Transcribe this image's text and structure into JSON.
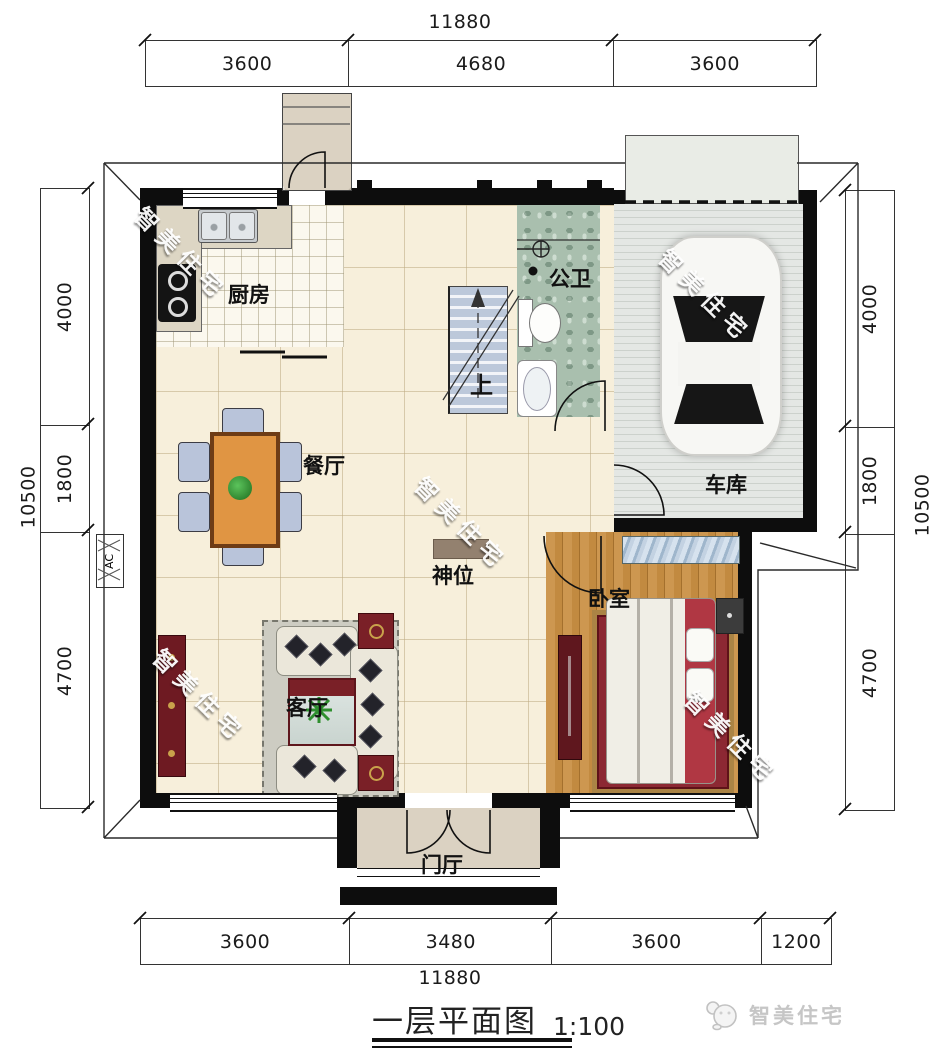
{
  "plan": {
    "title": "一层平面图",
    "scale": "1:100",
    "brand": "智美住宅",
    "watermark": "智美住宅"
  },
  "dims": {
    "top": {
      "total": "11880",
      "segs": [
        "3600",
        "4680",
        "3600"
      ]
    },
    "bottom": {
      "total": "11880",
      "segs": [
        "3600",
        "3480",
        "3600",
        "1200"
      ]
    },
    "left": {
      "total": "10500",
      "segs": [
        "4000",
        "1800",
        "4700"
      ]
    },
    "right": {
      "total": "10500",
      "segs": [
        "4000",
        "1800",
        "4700"
      ]
    }
  },
  "rooms": {
    "kitchen": "厨房",
    "bath": "公卫",
    "garage": "车库",
    "dining": "餐厅",
    "shrine": "神位",
    "bedroom": "卧室",
    "living": "客厅",
    "foyer": "门厅"
  },
  "annotations": {
    "stairs_up": "上",
    "ac": "AC"
  },
  "colors": {
    "wall": "#0d0d0d",
    "floor_cream": "#f7efdb",
    "bath_green": "#a9bfae",
    "wood": "#c28a40",
    "accent_red": "#7a1f28",
    "table_wood": "#e09543"
  }
}
